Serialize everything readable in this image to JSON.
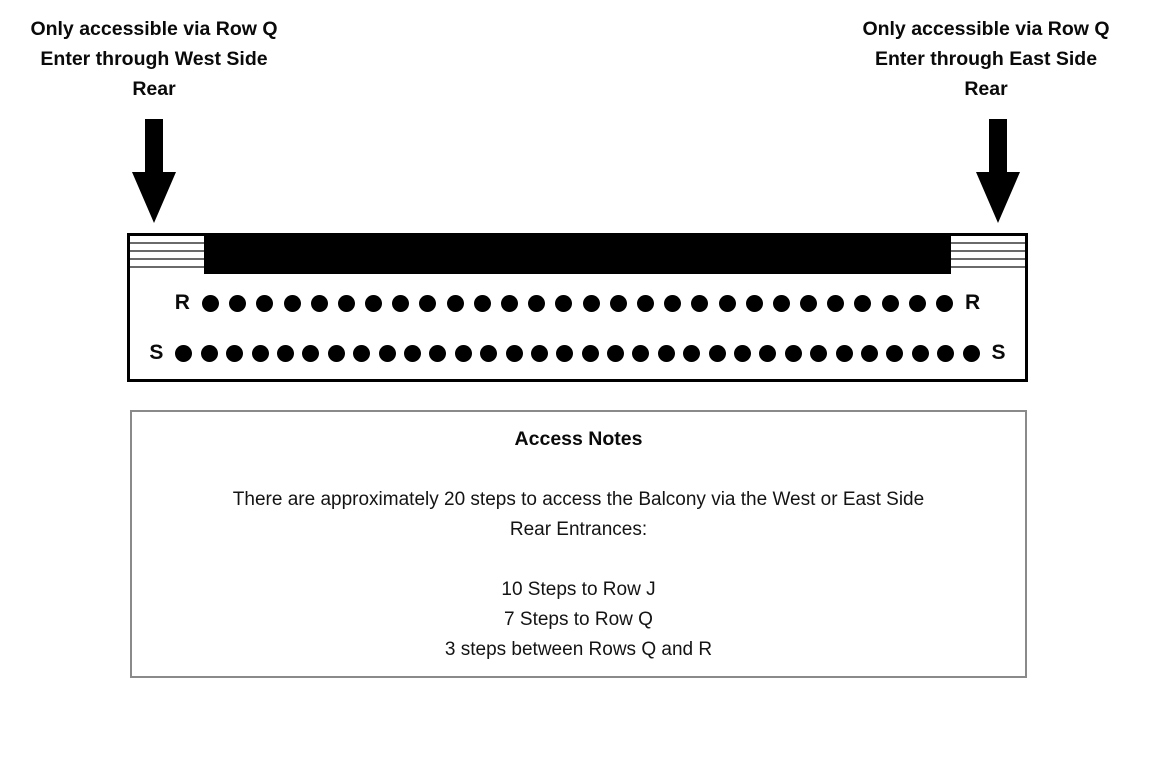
{
  "annotations": {
    "west": {
      "lines": [
        "Only accessible via Row Q",
        "Enter through West Side",
        "Rear"
      ]
    },
    "east": {
      "lines": [
        "Only accessible via Row Q",
        "Enter through East Side",
        "Rear"
      ]
    }
  },
  "seating": {
    "section": "Balcony",
    "rows": [
      {
        "label": "R",
        "seats": 28
      },
      {
        "label": "S",
        "seats": 32
      }
    ]
  },
  "access_notes": {
    "title": "Access Notes",
    "intro_lines": [
      "There are approximately 20 steps to access the Balcony via the West or East Side",
      "Rear Entrances:"
    ],
    "steps": [
      "10 Steps to Row J",
      "7 Steps to Row Q",
      "3 steps between Rows Q and R"
    ]
  },
  "colors": {
    "seat": "#000000",
    "wall": "#000000",
    "notes_border": "#8a8a8a",
    "text": "#0a0a0a"
  }
}
